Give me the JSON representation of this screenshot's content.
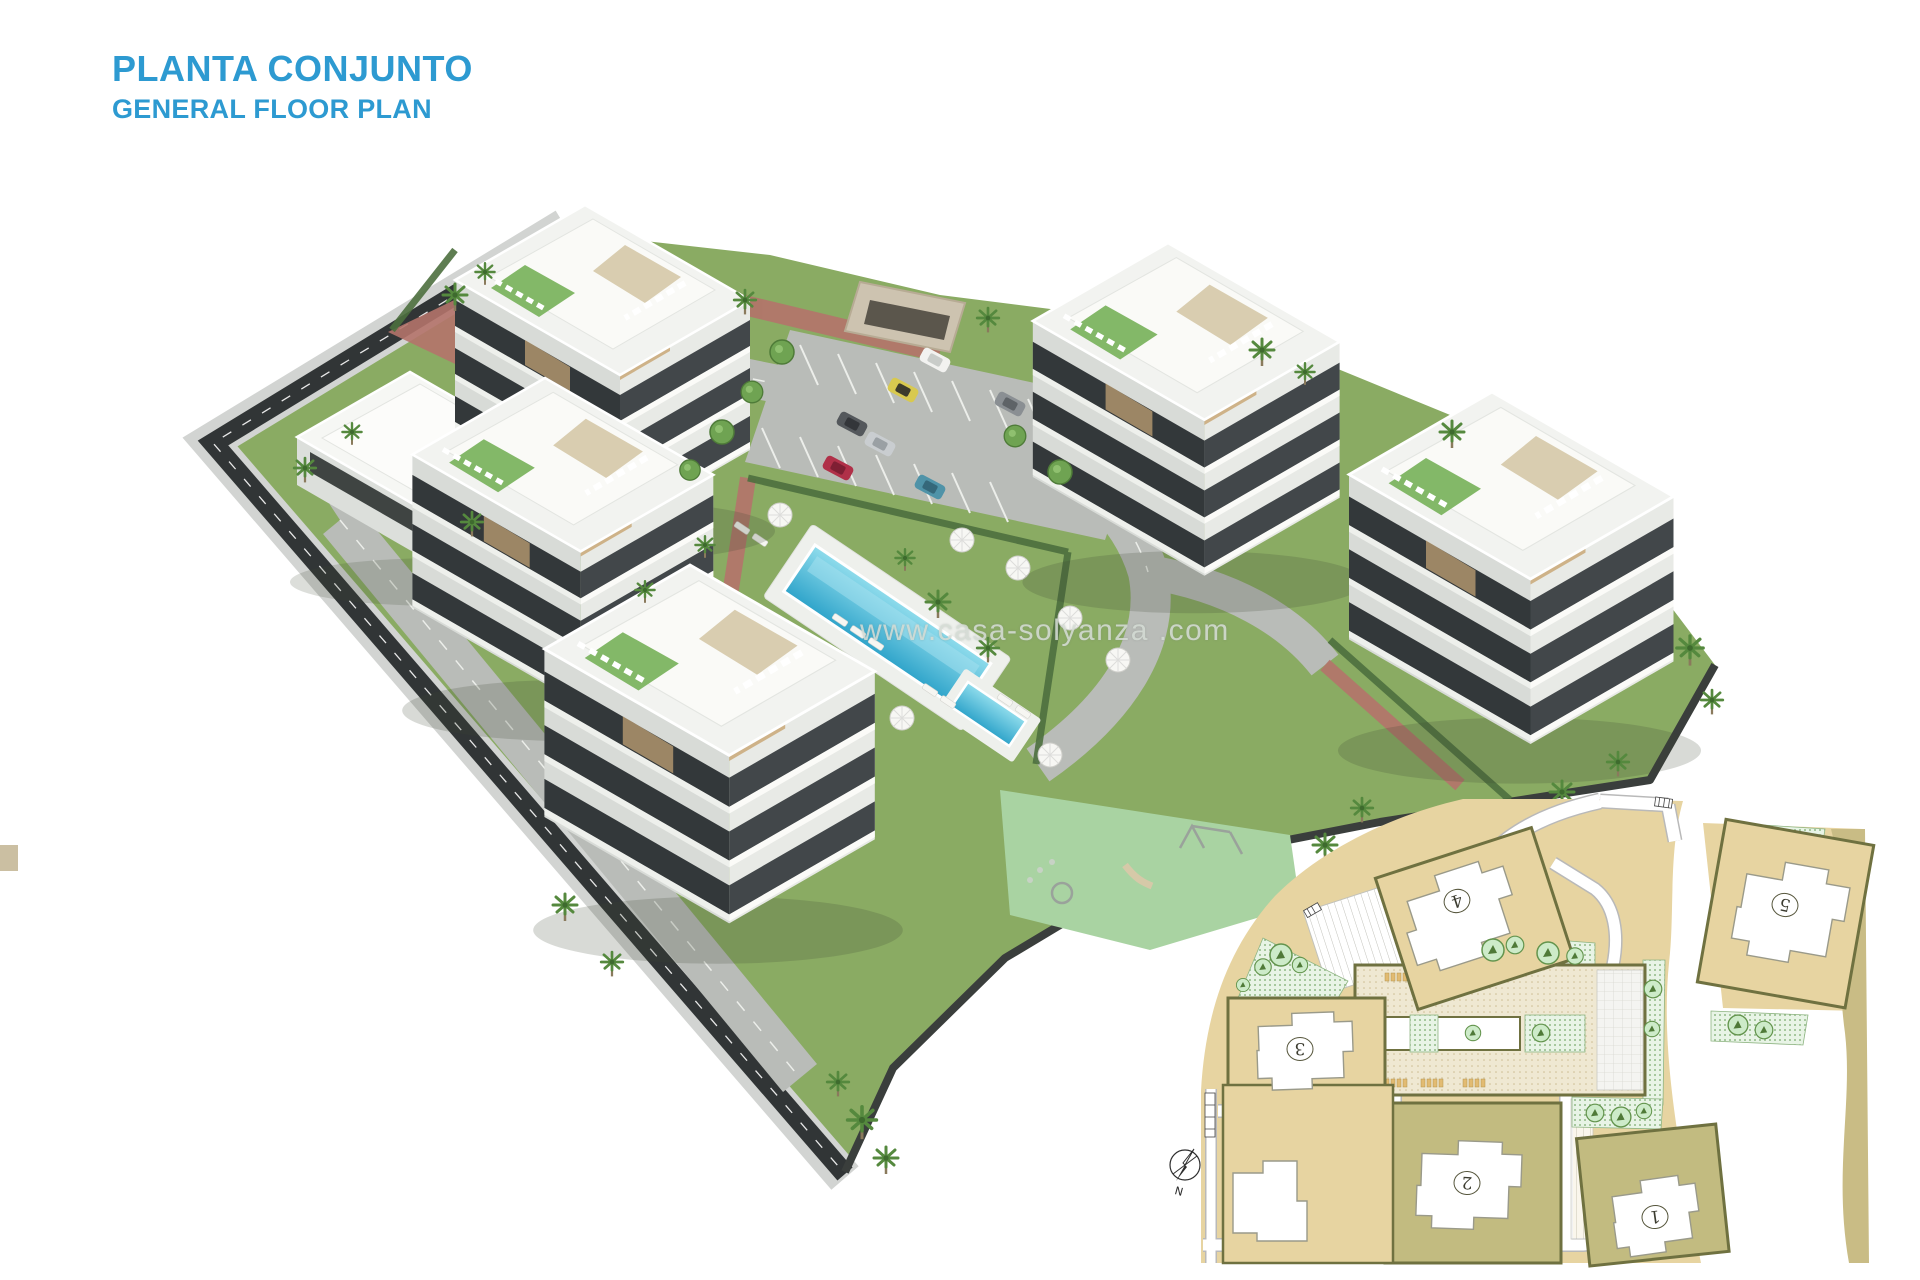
{
  "header": {
    "title": "PLANTA CONJUNTO",
    "subtitle": "GENERAL FLOOR PLAN",
    "accent_color": "#2d9ad1"
  },
  "watermark": {
    "text": "www.casa-solyanza .com"
  },
  "render": {
    "colors": {
      "lawn": "#8aab63",
      "asphalt_road": "#b9bcb8",
      "perimeter_road": "#313536",
      "sidewalk": "#d2d4d2",
      "brick_path": "#b4736a",
      "pool_water": "#49b8d6",
      "pool_deck": "#eef0ec",
      "playground_surface": "#a9d3a2",
      "building_white": "#f2f3f0",
      "building_shade": "#d8dbd7",
      "window_glass": "#42474a",
      "hedge_green": "#4c6f3e",
      "palm_green": "#55893e"
    }
  },
  "inset": {
    "colors": {
      "land": "#e7d4a1",
      "plot_outline": "#6f7140",
      "khaki_band": "#c9bc85",
      "green_zone": "#e8f4e6",
      "road": "#ffffff"
    },
    "buildings": [
      {
        "number": "1"
      },
      {
        "number": "2"
      },
      {
        "number": "3"
      },
      {
        "number": "4"
      },
      {
        "number": "5"
      }
    ],
    "compass_label": "N"
  }
}
